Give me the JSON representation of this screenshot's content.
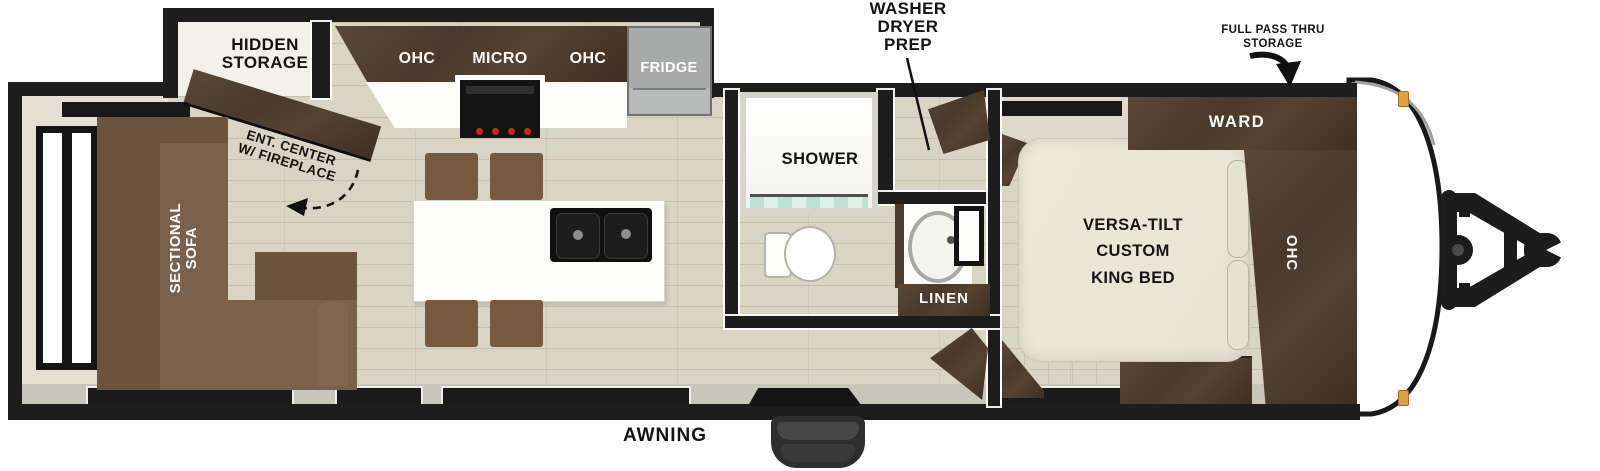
{
  "colors": {
    "wall": "#1d1d1d",
    "floor": "#d9d4c3",
    "cabinet_wood": "#4a392c",
    "sofa": "#7a614b",
    "bed": "#ece8d9",
    "counter": "#fdfdfa",
    "fridge": "#9fa1a0",
    "marker_light": "#e2a23b",
    "shower_glass": "#cfe9df"
  },
  "labels": {
    "hidden_storage": {
      "line1": "HIDDEN",
      "line2": "STORAGE"
    },
    "ent_center": {
      "line1": "ENT. CENTER",
      "line2": "W/ FIREPLACE"
    },
    "sectional_sofa": {
      "line1": "SECTIONAL",
      "line2": "SOFA"
    },
    "kitchen": {
      "ohc_left": "OHC",
      "micro": "MICRO",
      "ohc_right": "OHC",
      "fridge": "FRIDGE"
    },
    "washer_dryer_prep": {
      "line1": "WASHER",
      "line2": "DRYER",
      "line3": "PREP"
    },
    "shower": "SHOWER",
    "linen": "LINEN",
    "full_pass_thru": {
      "line1": "FULL PASS THRU",
      "line2": "STORAGE"
    },
    "ward": "WARD",
    "bed": {
      "line1": "VERSA-TILT",
      "line2": "CUSTOM",
      "line3": "KING BED"
    },
    "bed_ohc": "OHC",
    "awning": "AWNING"
  }
}
